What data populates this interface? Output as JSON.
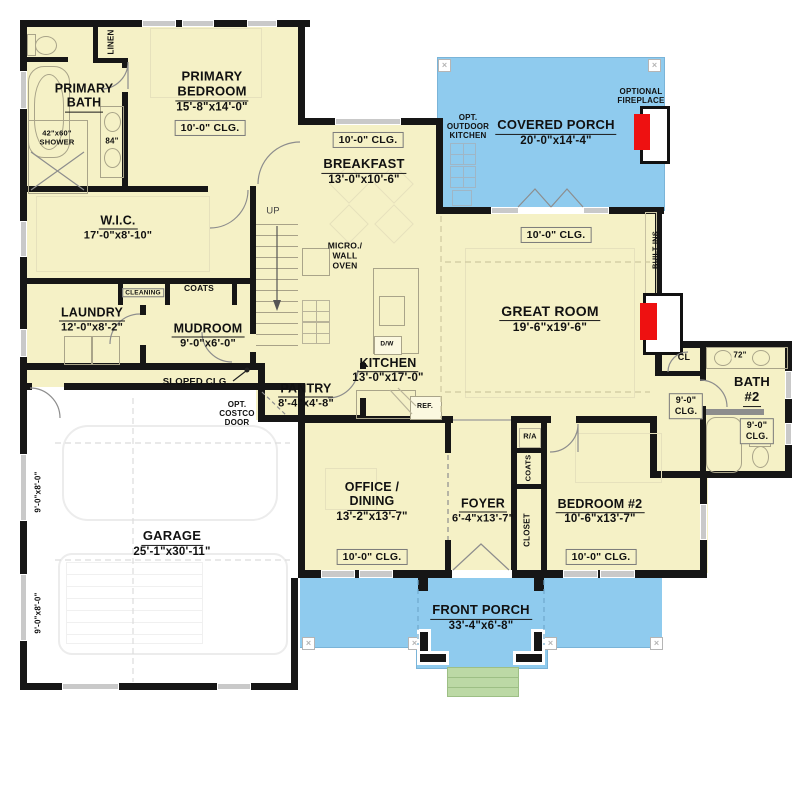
{
  "colors": {
    "floor": "#f5f1c6",
    "porch_blue": "#8fcbee",
    "steps_green": "#bcd9a5",
    "wall": "#161616",
    "fireplace_red": "#ee1111"
  },
  "rooms": {
    "primary_bath": {
      "name_line1": "PRIMARY",
      "name_line2": "BATH"
    },
    "primary_bedroom": {
      "name_line1": "PRIMARY",
      "name_line2": "BEDROOM",
      "dim": "15'-8\"x14'-0\"",
      "clg": "10'-0\" CLG."
    },
    "wic": {
      "name": "W.I.C.",
      "dim": "17'-0\"x8'-10\""
    },
    "laundry": {
      "name": "LAUNDRY",
      "dim": "12'-0\"x8'-2\""
    },
    "mudroom": {
      "name": "MUDROOM",
      "dim": "9'-0\"x6'-0\""
    },
    "breakfast": {
      "name": "BREAKFAST",
      "dim": "13'-0\"x10'-6\"",
      "clg": "10'-0\" CLG."
    },
    "kitchen": {
      "name": "KITCHEN",
      "dim": "13'-0\"x17'-0\""
    },
    "pantry": {
      "name": "PANTRY",
      "dim": "8'-4\"x4'-8\""
    },
    "great_room": {
      "name": "GREAT ROOM",
      "dim": "19'-6\"x19'-6\"",
      "clg": "10'-0\" CLG."
    },
    "covered_porch": {
      "name": "COVERED PORCH",
      "dim": "20'-0\"x14'-4\""
    },
    "office_dining": {
      "name_line1": "OFFICE /",
      "name_line2": "DINING",
      "dim": "13'-2\"x13'-7\"",
      "clg": "10'-0\" CLG."
    },
    "foyer": {
      "name": "FOYER",
      "dim": "6'-4\"x13'-7\""
    },
    "bedroom2": {
      "name": "BEDROOM #2",
      "dim": "10'-6\"x13'-7\"",
      "clg": "10'-0\" CLG."
    },
    "bath2": {
      "name_line1": "BATH",
      "name_line2": "#2",
      "clg_line1": "9'-0\"",
      "clg_line2": "CLG."
    },
    "hall": {
      "clg_line1": "9'-0\"",
      "clg_line2": "CLG."
    },
    "garage": {
      "name": "GARAGE",
      "dim": "25'-1\"x30'-11\"",
      "door_dim": "9'-0\"x8'-0\""
    },
    "front_porch": {
      "name": "FRONT PORCH",
      "dim": "33'-4\"x6'-8\""
    }
  },
  "annotations": {
    "linen": "LINEN",
    "vanity_84": "84\"",
    "shower_line1": "42\"x60\"",
    "shower_line2": "SHOWER",
    "cleaning": "CLEANING",
    "coats_mudroom": "COATS",
    "up": "UP",
    "sloped_clg": "SLOPED CLG.",
    "costco_line1": "OPT.",
    "costco_line2": "COSTCO",
    "costco_line3": "DOOR",
    "micro_line1": "MICRO./",
    "micro_line2": "WALL",
    "micro_line3": "OVEN",
    "dw": "D/W",
    "ref": "REF.",
    "outdoor_kitchen_line1": "OPT.",
    "outdoor_kitchen_line2": "OUTDOOR",
    "outdoor_kitchen_line3": "KITCHEN",
    "optional_fireplace_line1": "OPTIONAL",
    "optional_fireplace_line2": "FIREPLACE",
    "built_ins": "BUILT-INS",
    "cl": "CL",
    "vanity_72": "72\"",
    "ra": "R/A",
    "coats_foyer": "COATS",
    "closet": "CLOSET"
  }
}
